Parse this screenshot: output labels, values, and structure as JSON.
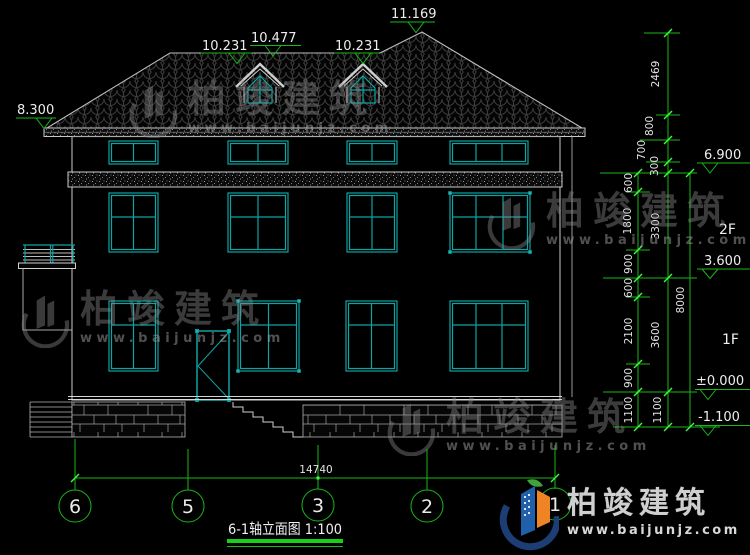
{
  "drawing": {
    "title": "6-1轴立面图 1:100"
  },
  "top_elevations": {
    "left_eave": "8.300",
    "dormer_left": "10.231",
    "dormer_mid": "10.477",
    "dormer_right": "10.231",
    "ridge": "11.169"
  },
  "right_elevations": {
    "attic": "6.900",
    "second": "3.600",
    "ground": "±0.000",
    "base": "-1.100",
    "floor_2": "2F",
    "floor_1": "1F"
  },
  "dim_chain_top": [
    "2469",
    "800",
    "700",
    "300"
  ],
  "dim_chain_detail": [
    "600",
    "1800",
    "900",
    "600",
    "2100",
    "900",
    "1100"
  ],
  "dim_chain_floor": [
    "3300",
    "3600",
    "1100"
  ],
  "dim_total_height": "8000",
  "dim_total_width": "14740",
  "grid_bubbles": [
    "6",
    "5",
    "3",
    "2",
    "1"
  ],
  "watermark": {
    "brand": "柏竣建筑",
    "site": "www.baijunjz.com"
  },
  "logo": {
    "brand": "柏竣建筑",
    "site": "www.baijunjz.com"
  },
  "colors": {
    "cad_green": "#17b817",
    "cad_teal": "#0da3a3",
    "line_gray": "#c4c4c4",
    "logo_navy": "#1d3e75",
    "logo_blue": "#2060aa",
    "logo_orange": "#ef8425",
    "logo_green": "#3fa23f"
  }
}
